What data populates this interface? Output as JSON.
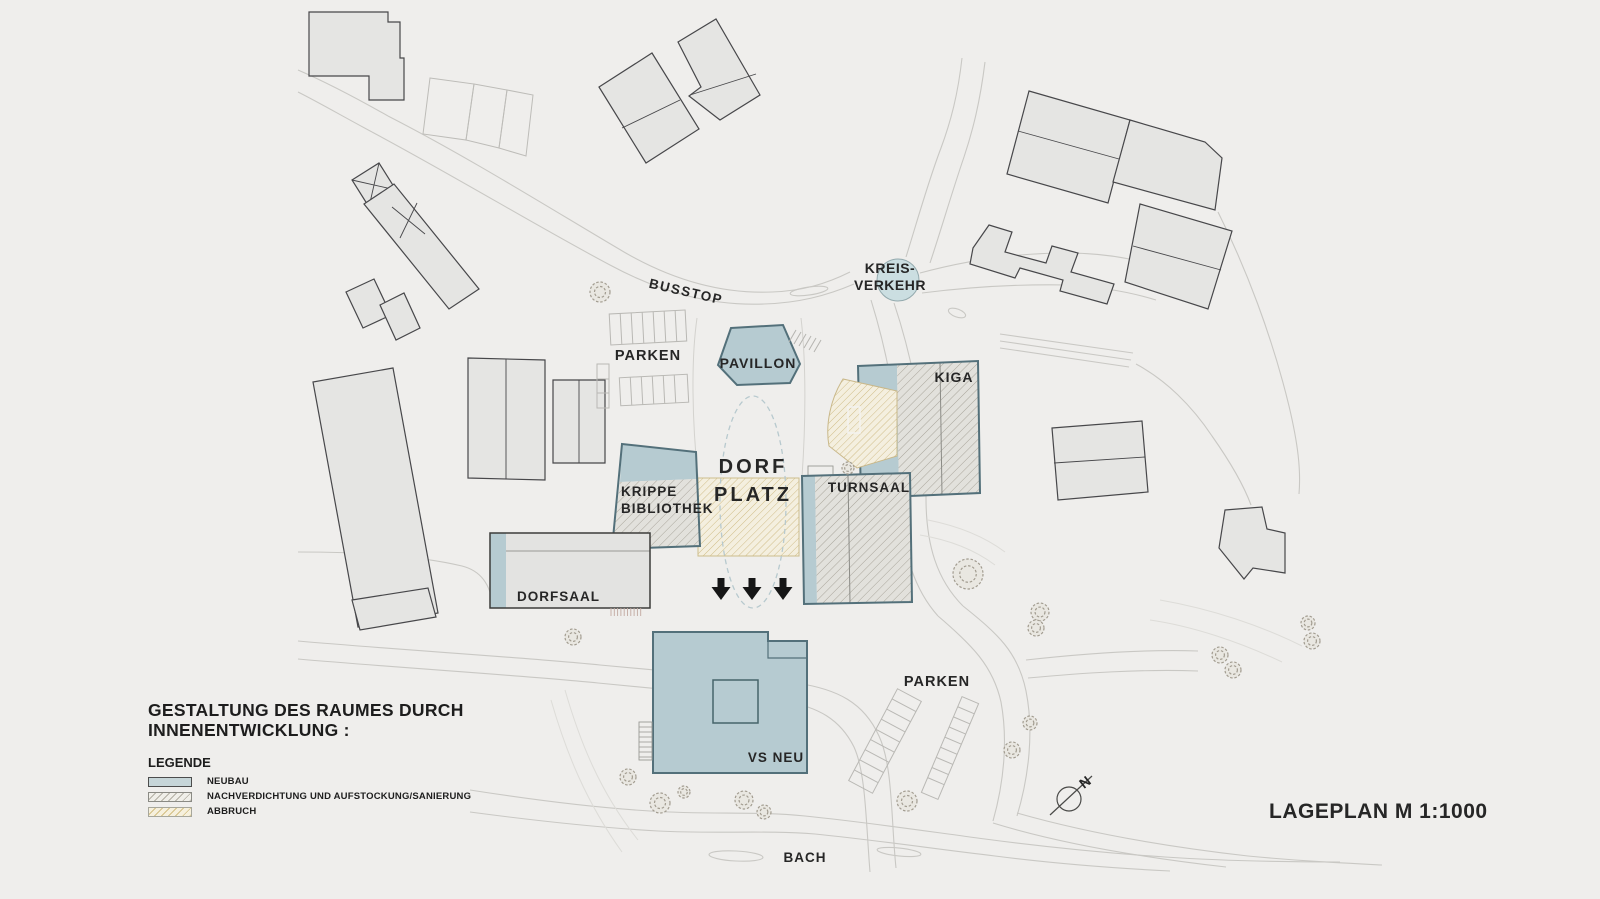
{
  "title": {
    "line1": "GESTALTUNG DES RAUMES DURCH",
    "line2": "INNENENTWICKLUNG :"
  },
  "legend": {
    "heading": "LEGENDE",
    "items": [
      {
        "label": "NEUBAU",
        "swatch": "neubau",
        "color": "#c6d5d8"
      },
      {
        "label": "NACHVERDICHTUNG UND AUFSTOCKUNG/SANIERUNG",
        "swatch": "sanierung",
        "hatch_line_color": "#a9a59b"
      },
      {
        "label": "ABBRUCH",
        "swatch": "abbruch",
        "hatch_line_color": "#ccb87e"
      }
    ]
  },
  "plan": {
    "labels": [
      {
        "id": "busstop",
        "text": "BUSSTOP",
        "x": 685,
        "y": 296,
        "size": 13.5,
        "ls": 1.5,
        "rotate": 13
      },
      {
        "id": "parken-top",
        "text": "PARKEN",
        "x": 648,
        "y": 360,
        "size": 14.5,
        "ls": 1
      },
      {
        "id": "pavillon",
        "text": "PAVILLON",
        "x": 758,
        "y": 368,
        "size": 14,
        "ls": 1
      },
      {
        "id": "kreis-line1",
        "text": "KREIS-",
        "x": 890,
        "y": 273,
        "size": 14,
        "ls": 0.5
      },
      {
        "id": "kreis-line2",
        "text": "VERKEHR",
        "x": 890,
        "y": 290,
        "size": 14,
        "ls": 0.5
      },
      {
        "id": "kiga",
        "text": "KIGA",
        "x": 954,
        "y": 382,
        "size": 14,
        "ls": 1
      },
      {
        "id": "turnsaal",
        "text": "TURNSAAL",
        "x": 869,
        "y": 492,
        "size": 13.5,
        "ls": 1
      },
      {
        "id": "krippe-line1",
        "text": "KRIPPE",
        "x": 621,
        "y": 496,
        "size": 13.5,
        "ls": 1,
        "anchor": "start"
      },
      {
        "id": "krippe-line2",
        "text": "BIBLIOTHEK",
        "x": 621,
        "y": 513,
        "size": 13.5,
        "ls": 1,
        "anchor": "start"
      },
      {
        "id": "dorf",
        "text": "DORF",
        "x": 753,
        "y": 473,
        "size": 20,
        "ls": 3
      },
      {
        "id": "platz",
        "text": "PLATZ",
        "x": 753,
        "y": 501,
        "size": 20,
        "ls": 3
      },
      {
        "id": "dorfsaal",
        "text": "DORFSAAL",
        "x": 517,
        "y": 601,
        "size": 13.5,
        "ls": 1,
        "anchor": "start"
      },
      {
        "id": "vs-neu",
        "text": "VS NEU",
        "x": 776,
        "y": 762,
        "size": 13.5,
        "ls": 1
      },
      {
        "id": "parken-bottom",
        "text": "PARKEN",
        "x": 937,
        "y": 686,
        "size": 14.5,
        "ls": 1
      },
      {
        "id": "bach",
        "text": "BACH",
        "x": 805,
        "y": 862,
        "size": 13.5,
        "ls": 1
      },
      {
        "id": "north-n",
        "text": "N",
        "x": 1088,
        "y": 786,
        "size": 14,
        "rotate": -38
      },
      {
        "id": "scale",
        "text": "LAGEPLAN M 1:1000",
        "x": 1269,
        "y": 818,
        "size": 21,
        "ls": 0.5,
        "anchor": "start"
      }
    ]
  },
  "colors": {
    "background": "#efeeec",
    "neubau_fill": "#b6cbd1",
    "neubau_stroke": "#53707a",
    "context_fill": "#e5e5e3",
    "sanierung_hatch_line": "#a9a59b",
    "abbruch_hatch_line": "#ccb87e",
    "kreisverkehr_fill": "#cbdee1"
  }
}
